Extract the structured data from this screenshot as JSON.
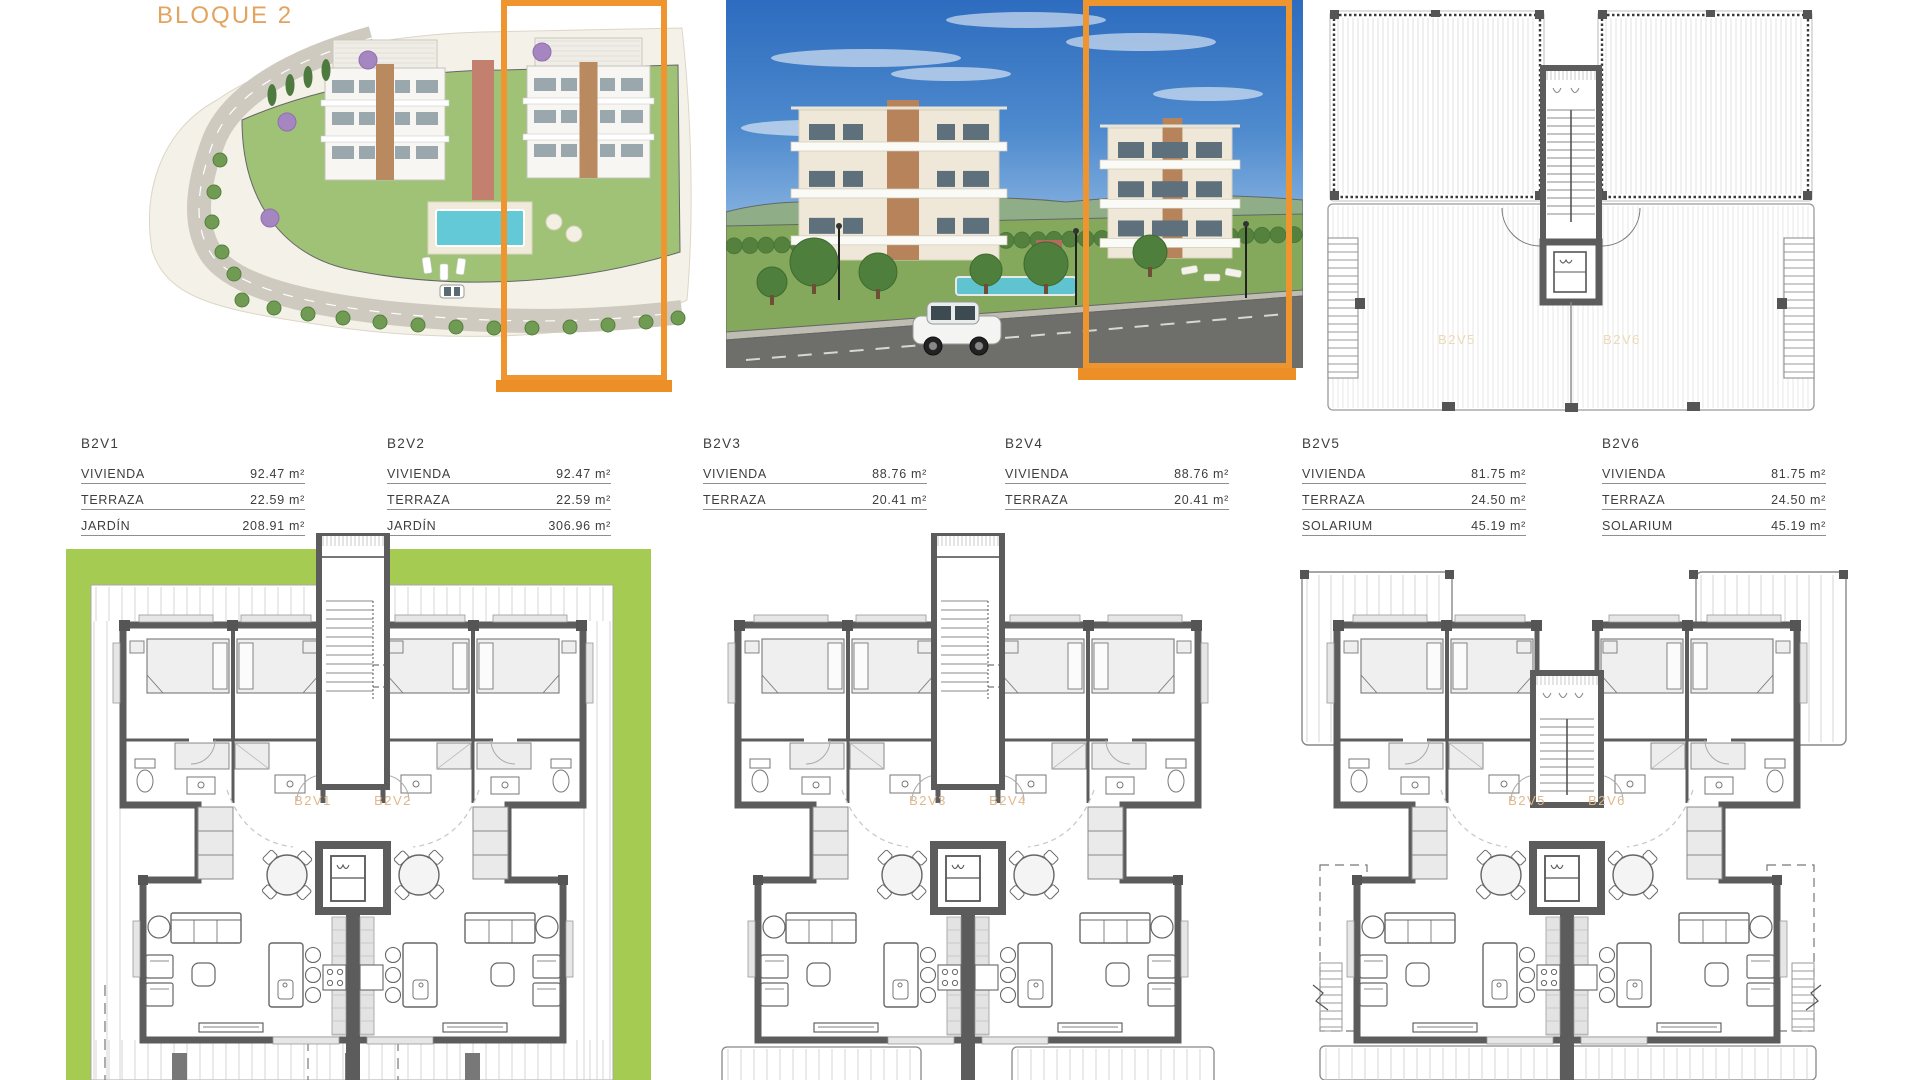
{
  "header": {
    "title": "BLOQUE 2"
  },
  "highlight_color": "#EF9530",
  "roof_plan": {
    "unit_left": "B2V5",
    "unit_right": "B2V6"
  },
  "tables": [
    {
      "title": "B2V1",
      "rows": [
        {
          "label": "VIVIENDA",
          "value": "92.47 m²"
        },
        {
          "label": "TERRAZA",
          "value": "22.59 m²"
        },
        {
          "label": "JARDÍN",
          "value": "208.91 m²"
        }
      ]
    },
    {
      "title": "B2V2",
      "rows": [
        {
          "label": "VIVIENDA",
          "value": "92.47 m²"
        },
        {
          "label": "TERRAZA",
          "value": "22.59 m²"
        },
        {
          "label": "JARDÍN",
          "value": "306.96 m²"
        }
      ]
    },
    {
      "title": "B2V3",
      "rows": [
        {
          "label": "VIVIENDA",
          "value": "88.76 m²"
        },
        {
          "label": "TERRAZA",
          "value": "20.41 m²"
        }
      ]
    },
    {
      "title": "B2V4",
      "rows": [
        {
          "label": "VIVIENDA",
          "value": "88.76 m²"
        },
        {
          "label": "TERRAZA",
          "value": "20.41 m²"
        }
      ]
    },
    {
      "title": "B2V5",
      "rows": [
        {
          "label": "VIVIENDA",
          "value": "81.75 m²"
        },
        {
          "label": "TERRAZA",
          "value": "24.50 m²"
        },
        {
          "label": "SOLARIUM",
          "value": "45.19 m²"
        }
      ]
    },
    {
      "title": "B2V6",
      "rows": [
        {
          "label": "VIVIENDA",
          "value": "81.75 m²"
        },
        {
          "label": "TERRAZA",
          "value": "24.50 m²"
        },
        {
          "label": "SOLARIUM",
          "value": "45.19 m²"
        }
      ]
    }
  ],
  "floor_plans": [
    {
      "unit_left": "B2V1",
      "unit_right": "B2V2"
    },
    {
      "unit_left": "B2V3",
      "unit_right": "B2V4"
    },
    {
      "unit_left": "B2V5",
      "unit_right": "B2V6"
    }
  ]
}
